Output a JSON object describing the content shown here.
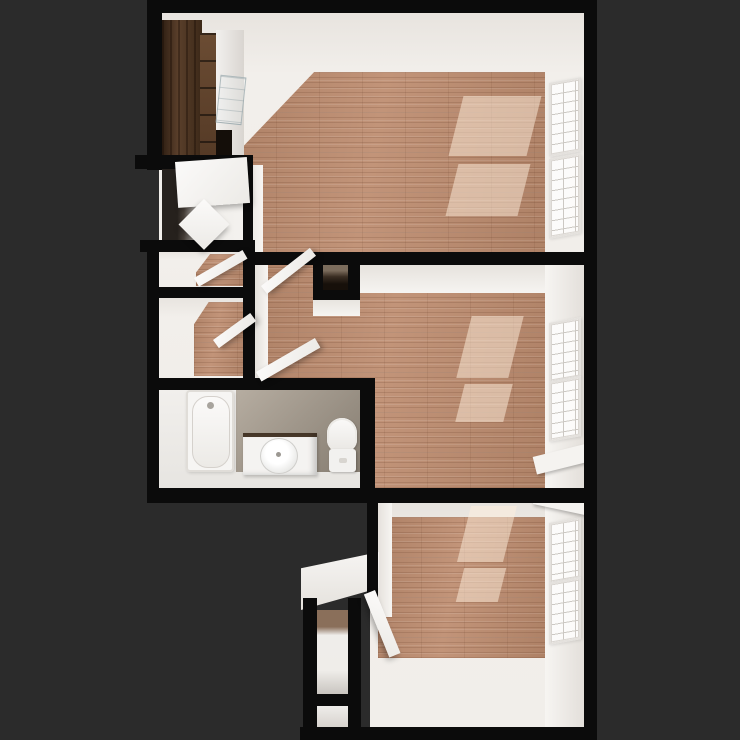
{
  "scene": {
    "kind": "3d-rendered-floor-plan-top-down-view",
    "colors": {
      "background": "#2b2b2b",
      "wall": "#0b0b0b",
      "wall_face": "#f2efeb",
      "wall_face_shade": "#e2deda",
      "wood_base": "#c29479",
      "wood_shade": "#ae8166",
      "white_floor": "#efedea",
      "tile": "#a89e92",
      "tile_dark": "#857c70",
      "cabinet_dark": "#4a3322",
      "cabinet_mid": "#5f442e",
      "fixture_white": "#f6f5f3",
      "sunlight": "rgba(255,239,222,0.5)",
      "window_frame": "#e4e1dd",
      "window_pane_line": "#ccc8c3",
      "dark_closet": "#17100a"
    },
    "rooms": [
      {
        "id": "living-room-kitchenette",
        "position": "top"
      },
      {
        "id": "entry-foyer",
        "position": "upper-left"
      },
      {
        "id": "closet-upper",
        "position": "mid-left"
      },
      {
        "id": "closet-lower",
        "position": "mid-left"
      },
      {
        "id": "hallway",
        "position": "center"
      },
      {
        "id": "hall-closet",
        "position": "center"
      },
      {
        "id": "bedroom-middle",
        "position": "mid-right"
      },
      {
        "id": "bathroom",
        "position": "lower-left"
      },
      {
        "id": "bedroom-bottom",
        "position": "bottom-right"
      },
      {
        "id": "laundry-closet",
        "position": "bottom-left"
      },
      {
        "id": "storage-closet",
        "position": "bottom-left"
      }
    ],
    "fixtures": [
      "kitchen-tall-cabinet",
      "kitchen-base-cabinets",
      "kitchen-counter",
      "kitchen-glass-shelf",
      "bathtub",
      "vanity-sink",
      "toilet",
      "window-sill",
      "laundry-ledge"
    ],
    "window_count": 6,
    "door_count": 7,
    "sunlight_patch_count": 6
  }
}
